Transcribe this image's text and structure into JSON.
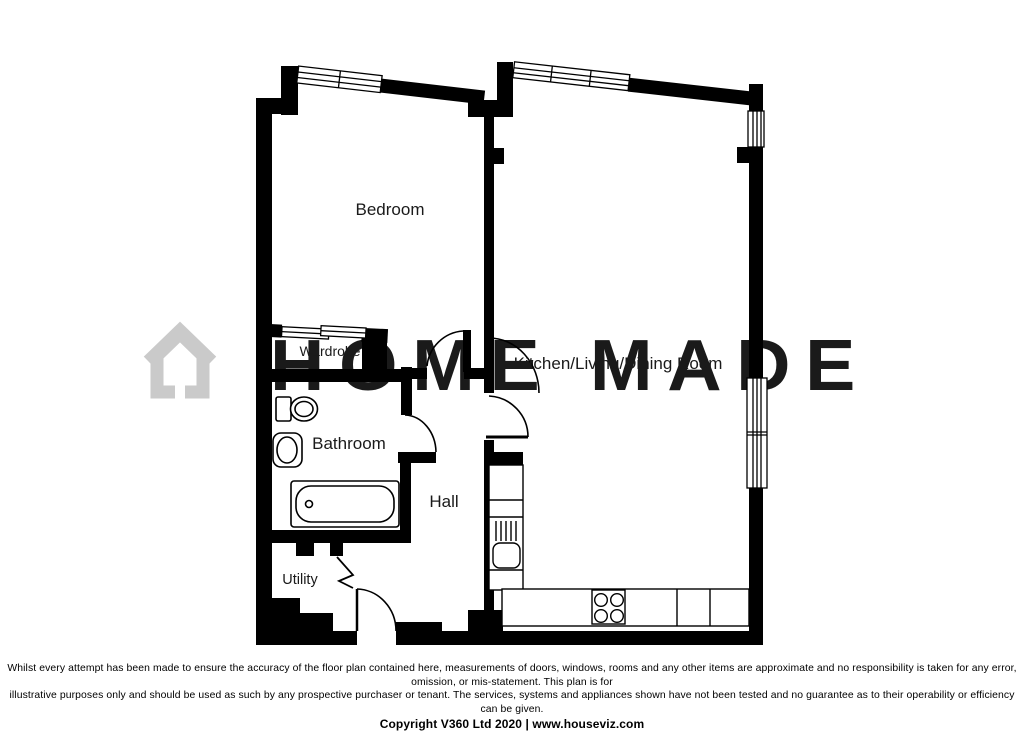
{
  "watermark": {
    "text": "HOME MADE"
  },
  "rooms": {
    "bedroom": "Bedroom",
    "wardrobe": "Wardrobe",
    "bathroom": "Bathroom",
    "hall": "Hall",
    "utility": "Utility",
    "kitchen": "Kitchen/Living/Dining Room"
  },
  "footer": {
    "disclaimer_line1": "Whilst every attempt has been made to ensure the accuracy of the floor plan contained here, measurements of doors, windows, rooms and any other items are approximate and no responsibility is taken for any error, omission, or mis-statement. This plan is for",
    "disclaimer_line2": "illustrative purposes only and should be used as such by any prospective purchaser or tenant. The services, systems and appliances shown have not been tested and no guarantee as to their operability or efficiency can be given.",
    "copyright": "Copyright V360 Ltd 2020 | www.houseviz.com"
  },
  "colors": {
    "wall": "#000000",
    "watermark": "#cacaca",
    "background": "#ffffff"
  }
}
